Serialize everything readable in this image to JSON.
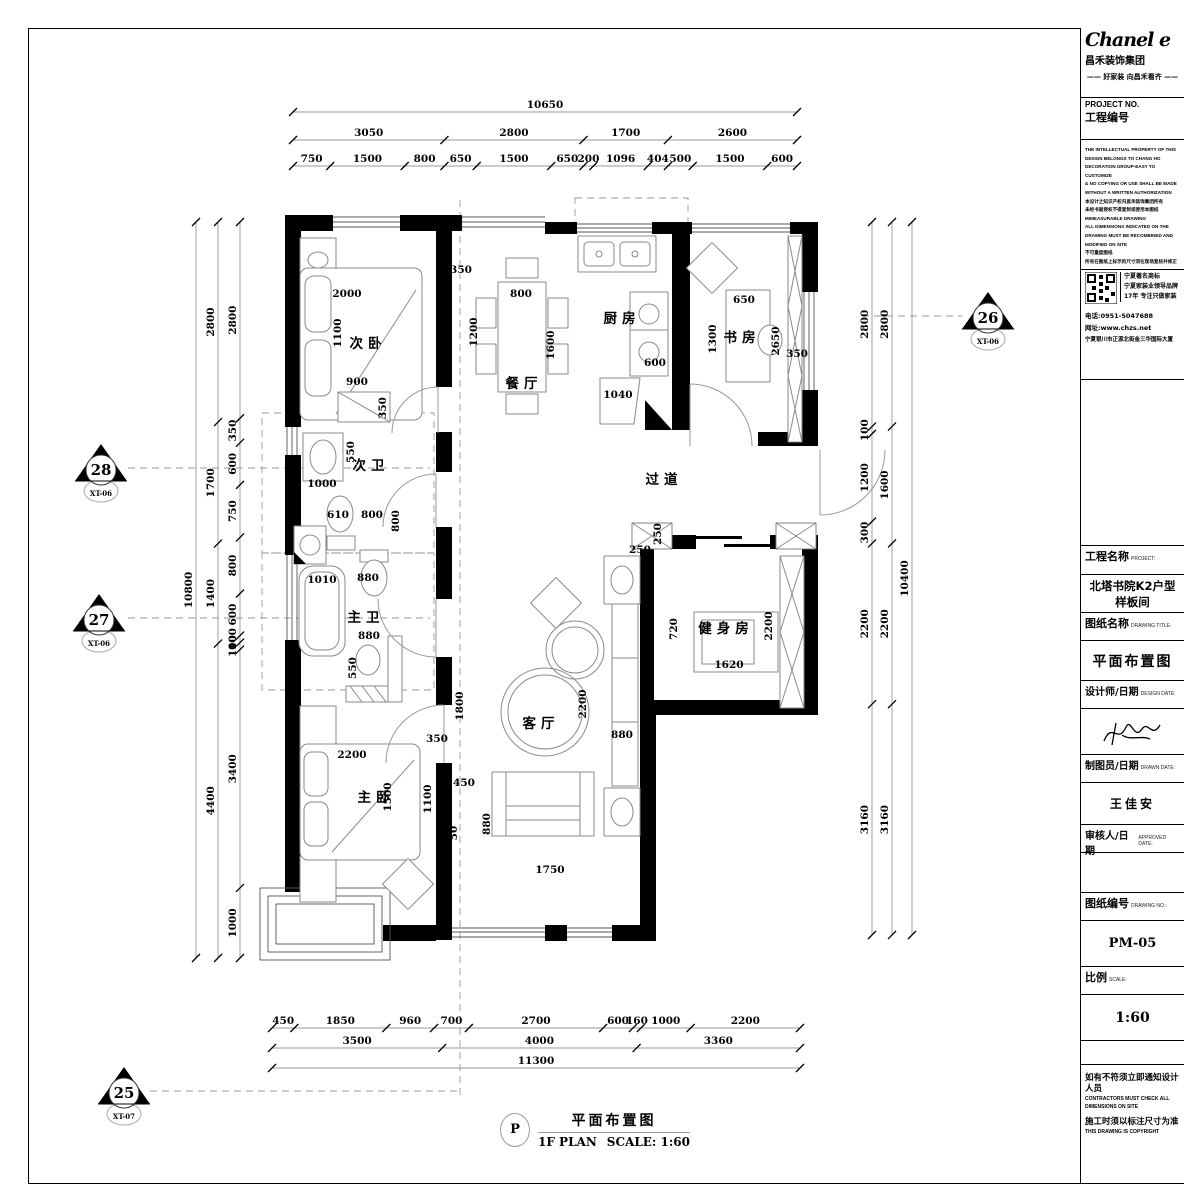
{
  "title_block": {
    "logo": {
      "brand": "Chanel e",
      "company": "昌禾装饰集团",
      "tagline": "—— 好家装 向昌禾看齐 ——"
    },
    "project_no": {
      "label_en": "PROJECT  NO.",
      "label_cn": "工程编号"
    },
    "legal_lines": [
      "THE INTELLECTUAL PROPERTY OF THIS",
      "DESIGN BELONGS TO CHANG HO",
      "DECORATION GROUP-EASY TO CUSTOMIZE",
      "& NO COPYING OR USE SHALL BE MADE",
      "WITHOUT A WRITTEN AUTHORIZATION",
      "本设计之知识产权归昌禾装饰集团所有",
      "未经书面授权不得复制或使用本图纸",
      "IMMEASURABLE DRAWING",
      "ALL DIMENSIONS INDICATED ON THE",
      "DRAWING MUST BE RECOMBINED AND",
      "MODIFIED ON SITE",
      "不可量度图纸",
      "所有在图纸上标示的尺寸须在现场复核并修正"
    ],
    "brand_box": {
      "qr_icon": "qr-code",
      "lines": [
        "宁夏著名商标",
        "宁夏家装业领导品牌",
        "17年 专注只做家装"
      ],
      "phone": "电话:0951-5047688",
      "web": "网址:www.chzs.net",
      "address": "宁夏银川市正源北街金三华国际大厦"
    },
    "fields": [
      {
        "label_cn": "工程名称",
        "label_en": "PROJECT:",
        "value": "北塔书院K2户型样板间"
      },
      {
        "label_cn": "图纸名称",
        "label_en": "DRAWING TITLE:",
        "value": "平面布置图"
      },
      {
        "label_cn": "设计师/日期",
        "label_en": "DESIGN DATE:",
        "value": ""
      },
      {
        "label_cn": "制图员/日期",
        "label_en": "DRAWN DATE:",
        "value": "王佳安"
      },
      {
        "label_cn": "审核人/日期",
        "label_en": "APPROVED DATE:",
        "value": ""
      },
      {
        "label_cn": "图纸编号",
        "label_en": "DRAWING NO.:",
        "value": "PM-05"
      },
      {
        "label_cn": "比例",
        "label_en": "SCALE:",
        "value": "1:60"
      }
    ],
    "notes": [
      "如有不符须立即通知设计人员",
      "CONTRACTORS MUST CHECK ALL DIMENSIONS ON SITE",
      "施工时须以标注尺寸为准",
      "THIS DRAWING IS COPYRIGHT"
    ]
  },
  "drawing_title": {
    "bubble": "P",
    "title_cn": "平面布置图",
    "plan_label": "1F PLAN",
    "scale_label": "SCALE: 1:60"
  },
  "plan": {
    "markers": [
      {
        "num": "26",
        "code": "XT-06",
        "x": 988,
        "y": 316
      },
      {
        "num": "28",
        "code": "XT-06",
        "x": 101,
        "y": 468
      },
      {
        "num": "27",
        "code": "XT-06",
        "x": 99,
        "y": 618
      },
      {
        "num": "25",
        "code": "XT-07",
        "x": 124,
        "y": 1091
      }
    ],
    "texts": [
      {
        "t": "次卧",
        "x": 368,
        "y": 348,
        "cls": "room"
      },
      {
        "t": "餐厅",
        "x": 524,
        "y": 388,
        "cls": "room"
      },
      {
        "t": "厨房",
        "x": 622,
        "y": 323,
        "cls": "room"
      },
      {
        "t": "书房",
        "x": 742,
        "y": 342,
        "cls": "room"
      },
      {
        "t": "次卫",
        "x": 371,
        "y": 470,
        "cls": "room"
      },
      {
        "t": "主卫",
        "x": 366,
        "y": 622,
        "cls": "room"
      },
      {
        "t": "主卧",
        "x": 376,
        "y": 802,
        "cls": "room"
      },
      {
        "t": "客厅",
        "x": 541,
        "y": 728,
        "cls": "room"
      },
      {
        "t": "健身房",
        "x": 726,
        "y": 633,
        "cls": "room"
      },
      {
        "t": "过道",
        "x": 664,
        "y": 484,
        "cls": "room"
      },
      {
        "t": "2000",
        "x": 347,
        "y": 297,
        "cls": "dim"
      },
      {
        "t": "1100",
        "x": 341,
        "y": 333,
        "cls": "dim",
        "r": -90
      },
      {
        "t": "900",
        "x": 357,
        "y": 385,
        "cls": "dim"
      },
      {
        "t": "350",
        "x": 386,
        "y": 408,
        "cls": "dim",
        "r": -90
      },
      {
        "t": "350",
        "x": 461,
        "y": 273,
        "cls": "dim"
      },
      {
        "t": "800",
        "x": 521,
        "y": 297,
        "cls": "dim"
      },
      {
        "t": "1200",
        "x": 477,
        "y": 332,
        "cls": "dim",
        "r": -90
      },
      {
        "t": "1600",
        "x": 554,
        "y": 345,
        "cls": "dim",
        "r": -90
      },
      {
        "t": "600",
        "x": 655,
        "y": 366,
        "cls": "dim"
      },
      {
        "t": "1040",
        "x": 618,
        "y": 398,
        "cls": "dim"
      },
      {
        "t": "650",
        "x": 744,
        "y": 303,
        "cls": "dim"
      },
      {
        "t": "1300",
        "x": 716,
        "y": 339,
        "cls": "dim",
        "r": -90
      },
      {
        "t": "2650",
        "x": 779,
        "y": 341,
        "cls": "dim",
        "r": -90
      },
      {
        "t": "350",
        "x": 797,
        "y": 357,
        "cls": "dim"
      },
      {
        "t": "550",
        "x": 354,
        "y": 452,
        "cls": "dim",
        "r": -90
      },
      {
        "t": "1000",
        "x": 322,
        "y": 487,
        "cls": "dim"
      },
      {
        "t": "610",
        "x": 338,
        "y": 518,
        "cls": "dim"
      },
      {
        "t": "800",
        "x": 372,
        "y": 518,
        "cls": "dim"
      },
      {
        "t": "800",
        "x": 399,
        "y": 521,
        "cls": "dim",
        "r": -90
      },
      {
        "t": "1010",
        "x": 322,
        "y": 583,
        "cls": "dim"
      },
      {
        "t": "880",
        "x": 368,
        "y": 581,
        "cls": "dim"
      },
      {
        "t": "880",
        "x": 369,
        "y": 639,
        "cls": "dim"
      },
      {
        "t": "550",
        "x": 356,
        "y": 668,
        "cls": "dim",
        "r": -90
      },
      {
        "t": "2200",
        "x": 352,
        "y": 758,
        "cls": "dim"
      },
      {
        "t": "1500",
        "x": 391,
        "y": 797,
        "cls": "dim",
        "r": -90
      },
      {
        "t": "350",
        "x": 437,
        "y": 742,
        "cls": "dim"
      },
      {
        "t": "1100",
        "x": 431,
        "y": 799,
        "cls": "dim",
        "r": -90
      },
      {
        "t": "450",
        "x": 464,
        "y": 786,
        "cls": "dim"
      },
      {
        "t": "50",
        "x": 457,
        "y": 833,
        "cls": "dim",
        "r": -90
      },
      {
        "t": "1800",
        "x": 463,
        "y": 706,
        "cls": "dim",
        "r": -90
      },
      {
        "t": "880",
        "x": 490,
        "y": 824,
        "cls": "dim",
        "r": -90
      },
      {
        "t": "2200",
        "x": 586,
        "y": 704,
        "cls": "dim",
        "r": -90
      },
      {
        "t": "880",
        "x": 622,
        "y": 738,
        "cls": "dim"
      },
      {
        "t": "1750",
        "x": 550,
        "y": 873,
        "cls": "dim"
      },
      {
        "t": "720",
        "x": 677,
        "y": 629,
        "cls": "dim",
        "r": -90
      },
      {
        "t": "2200",
        "x": 772,
        "y": 626,
        "cls": "dim",
        "r": -90
      },
      {
        "t": "1620",
        "x": 729,
        "y": 668,
        "cls": "dim"
      },
      {
        "t": "250",
        "x": 661,
        "y": 534,
        "cls": "dim",
        "r": -90
      },
      {
        "t": "250",
        "x": 640,
        "y": 553,
        "cls": "dim"
      }
    ],
    "dim_chains": [
      {
        "o": "h",
        "pos": 112,
        "a0": 293,
        "a1": 797,
        "parts": [
          10650
        ]
      },
      {
        "o": "h",
        "pos": 140,
        "a0": 293,
        "a1": 797,
        "parts": [
          3050,
          2800,
          1700,
          2600
        ]
      },
      {
        "o": "h",
        "pos": 166,
        "a0": 293,
        "a1": 797,
        "parts": [
          750,
          1500,
          800,
          650,
          1500,
          650,
          200,
          1096,
          404,
          500,
          1500,
          600
        ]
      },
      {
        "o": "h",
        "pos": 1028,
        "a0": 272,
        "a1": 800,
        "parts": [
          450,
          1850,
          960,
          700,
          2700,
          600,
          160,
          1000,
          2200
        ]
      },
      {
        "o": "h",
        "pos": 1048,
        "a0": 272,
        "a1": 800,
        "parts": [
          3500,
          4000,
          3360
        ]
      },
      {
        "o": "h",
        "pos": 1068,
        "a0": 272,
        "a1": 800,
        "parts": [
          11300
        ]
      },
      {
        "o": "v",
        "pos": 240,
        "a0": 222,
        "a1": 958,
        "parts": [
          2800,
          350,
          600,
          750,
          800,
          600,
          100,
          100,
          3400,
          1000
        ]
      },
      {
        "o": "v",
        "pos": 218,
        "a0": 222,
        "a1": 958,
        "parts": [
          2800,
          1700,
          1400,
          4400
        ]
      },
      {
        "o": "v",
        "pos": 196,
        "a0": 222,
        "a1": 958,
        "parts": [
          10800
        ]
      },
      {
        "o": "v",
        "pos": 872,
        "a0": 222,
        "a1": 935,
        "parts": [
          2800,
          100,
          1200,
          300,
          2200,
          3160
        ]
      },
      {
        "o": "v",
        "pos": 892,
        "a0": 222,
        "a1": 935,
        "parts": [
          2800,
          1600,
          2200,
          3160
        ]
      },
      {
        "o": "v",
        "pos": 912,
        "a0": 222,
        "a1": 935,
        "parts": [
          10400
        ]
      }
    ]
  }
}
